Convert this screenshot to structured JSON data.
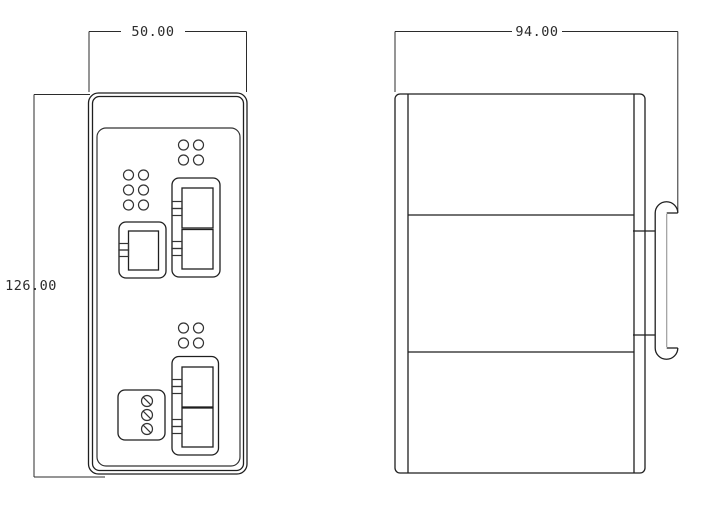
{
  "page": {
    "background": "#ffffff",
    "line_color": "#1f1f1f",
    "secondary_line_color": "#9c9c9c"
  },
  "drawing": {
    "dimensions": {
      "front_width_mm": "50.00",
      "front_height_mm": "126.00",
      "side_depth_mm": "94.00"
    }
  }
}
